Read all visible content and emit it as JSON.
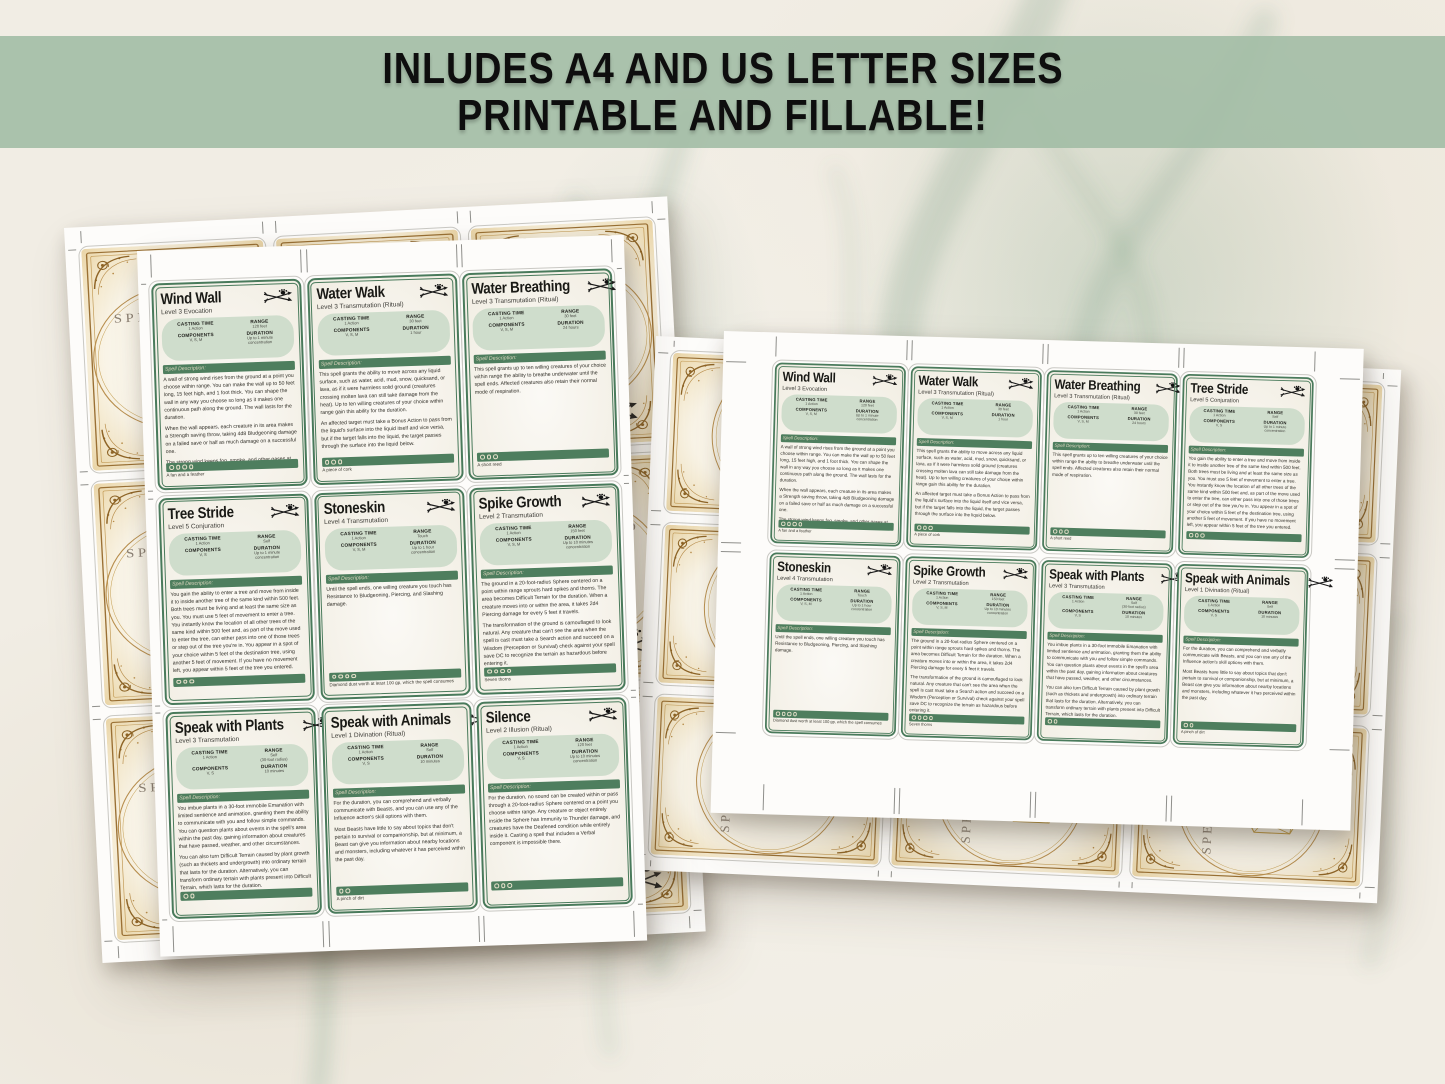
{
  "banner": {
    "line1": "INLUDES A4 AND US LETTER SIZES",
    "line2": "PRINTABLE AND FILLABLE!"
  },
  "labels": {
    "casting_time": "CASTING TIME",
    "range": "RANGE",
    "components": "COMPONENTS",
    "duration": "DURATION",
    "description_header": "Spell Description:",
    "card_back_title": "SPELL CARD"
  },
  "colors": {
    "banner_bg": "#a2bca5",
    "card_green": "#497a5b",
    "stat_pill_bg": "#cfddcc",
    "back_gold": "#a3722f",
    "d20_gold": "#c49d42"
  },
  "spells": [
    {
      "title": "Wind Wall",
      "level": "Level 3 Evocation",
      "casting_time": "1 Action",
      "range": "120 feet",
      "components": "V, S, M",
      "duration": "Up to 1 minute\nconcentration",
      "dots": 4,
      "material": "A fan and a feather",
      "description": [
        "A wall of strong wind rises from the ground at a point you choose within range. You can make the wall up to 50 feet long, 15 feet high, and 1 foot thick. You can shape the wall in any way you choose so long as it makes one continuous path along the ground. The wall lasts for the duration.",
        "When the wall appears, each creature in its area makes a Strength saving throw, taking 4d8 Bludgeoning damage on a failed save or half as much damage on a successful one.",
        "The strong wind keeps fog, smoke, and other gases at bay. Small or smaller flying creatures or objects can't pass through the wall. Loose, lightweight materials brought into the wall fly upward. Arrows, bolts, and other ordinary projectiles launched at targets behind the wall are deflected upward and miss automatically. Boulders hurled by Giants or siege engines, and similar projectiles, are unaffected. Creatures in gaseous form can't pass through it."
      ]
    },
    {
      "title": "Water Walk",
      "level": "Level 3 Transmutation (Ritual)",
      "casting_time": "1 Action",
      "range": "30 feet",
      "components": "V, S, M",
      "duration": "1 hour",
      "dots": 3,
      "material": "A piece of cork",
      "description": [
        "This spell grants the ability to move across any liquid surface, such as water, acid, mud, snow, quicksand, or lava, as if it were harmless solid ground (creatures crossing molten lava can still take damage from the heat). Up to ten willing creatures of your choice within range gain this ability for the duration.",
        "An affected target must take a Bonus Action to pass from the liquid's surface into the liquid itself and vice versa, but if the target falls into the liquid, the target passes through the surface into the liquid below."
      ]
    },
    {
      "title": "Water Breathing",
      "level": "Level 3 Transmutation (Ritual)",
      "casting_time": "1 Action",
      "range": "30 feet",
      "components": "V, S, M",
      "duration": "24 hours",
      "dots": 3,
      "material": "A short reed",
      "description": [
        "This spell grants up to ten willing creatures of your choice within range the ability to breathe underwater until the spell ends. Affected creatures also retain their normal mode of respiration."
      ]
    },
    {
      "title": "Tree Stride",
      "level": "Level 5 Conjuration",
      "casting_time": "1 Action",
      "range": "Self",
      "components": "V, S",
      "duration": "Up to 1 minute\nconcentration",
      "dots": 3,
      "material": "",
      "description": [
        "You gain the ability to enter a tree and move from inside it to inside another tree of the same kind within 500 feet. Both trees must be living and at least the same size as you. You must use 5 feet of movement to enter a tree. You instantly know the location of all other trees of the same kind within 500 feet and, as part of the move used to enter the tree, can either pass into one of those trees or step out of the tree you're in. You appear in a spot of your choice within 5 feet of the destination tree, using another 5 feet of movement. If you have no movement left, you appear within 5 feet of the tree you entered.",
        "You can use this transportation ability only once on each of your turns. You must end each turn outside a tree."
      ]
    },
    {
      "title": "Stoneskin",
      "level": "Level 4 Transmutation",
      "casting_time": "1 Action",
      "range": "Touch",
      "components": "V, S, M",
      "duration": "Up to 1 hour\nconcentration",
      "dots": 4,
      "material": "Diamond dust worth at least 100 gp, which the spell consumes",
      "description": [
        "Until the spell ends, one willing creature you touch has Resistance to Bludgeoning, Piercing, and Slashing damage."
      ]
    },
    {
      "title": "Spike Growth",
      "level": "Level 2 Transmutation",
      "casting_time": "1 Action",
      "range": "150 feet",
      "components": "V, S, M",
      "duration": "Up to 10 minutes\nconcentration",
      "dots": 4,
      "material": "Seven thorns",
      "description": [
        "The ground in a 20-foot-radius Sphere centered on a point within range sprouts hard spikes and thorns. The area becomes Difficult Terrain for the duration. When a creature moves into or within the area, it takes 2d4 Piercing damage for every 5 feet it travels.",
        "The transformation of the ground is camouflaged to look natural. Any creature that can't see the area when the spell is cast must take a Search action and succeed on a Wisdom (Perception or Survival) check against your spell save DC to recognize the terrain as hazardous before entering it."
      ]
    },
    {
      "title": "Speak with Plants",
      "level": "Level 3 Transmutation",
      "casting_time": "1 Action",
      "range": "Self\n(30-foot radius)",
      "components": "V, S",
      "duration": "10 minutes",
      "dots": 2,
      "material": "",
      "description": [
        "You imbue plants in a 30-foot immobile Emanation with limited sentience and animation, granting them the ability to communicate with you and follow simple commands. You can question plants about events in the spell's area within the past day, gaining information about creatures that have passed, weather, and other circumstances.",
        "You can also turn Difficult Terrain caused by plant growth (such as thickets and undergrowth) into ordinary terrain that lasts for the duration. Alternatively, you can transform ordinary terrain with plants present into Difficult Terrain, which lasts for the duration.",
        "The spell doesn't enable plants to uproot themselves and move about, but they can move their branches, tendrils, and stalks for you.",
        "If a Plant creature is in the area, you can communicate with it as if you shared a common language."
      ]
    },
    {
      "title": "Speak with Animals",
      "level": "Level 1 Divination (Ritual)",
      "casting_time": "1 Action",
      "range": "Self",
      "components": "V, S",
      "duration": "10 minutes",
      "dots": 2,
      "material": "A pinch of dirt",
      "description": [
        "For the duration, you can comprehend and verbally communicate with Beasts, and you can use any of the Influence action's skill options with them.",
        "Most Beasts have little to say about topics that don't pertain to survival or companionship, but at minimum, a Beast can give you information about nearby locations and monsters, including whatever it has perceived within the past day."
      ]
    },
    {
      "title": "Silence",
      "level": "Level 2 Illusion (Ritual)",
      "casting_time": "1 Action",
      "range": "120 feet",
      "components": "V, S",
      "duration": "Up to 10 minutes\nconcentration",
      "dots": 3,
      "material": "",
      "description": [
        "For the duration, no sound can be created within or pass through a 20-foot-radius Sphere centered on a point you choose within range. Any creature or object entirely inside the Sphere has Immunity to Thunder damage, and creatures have the Deafened condition while entirely inside it. Casting a spell that includes a Verbal component is impossible there."
      ]
    }
  ],
  "pages": {
    "a4_sheet": {
      "card_indices": [
        0,
        1,
        2,
        3,
        4,
        5,
        6,
        7,
        8
      ]
    },
    "us_letter_sheet": {
      "card_indices": [
        0,
        1,
        2,
        3,
        4,
        5,
        6,
        7
      ]
    }
  }
}
